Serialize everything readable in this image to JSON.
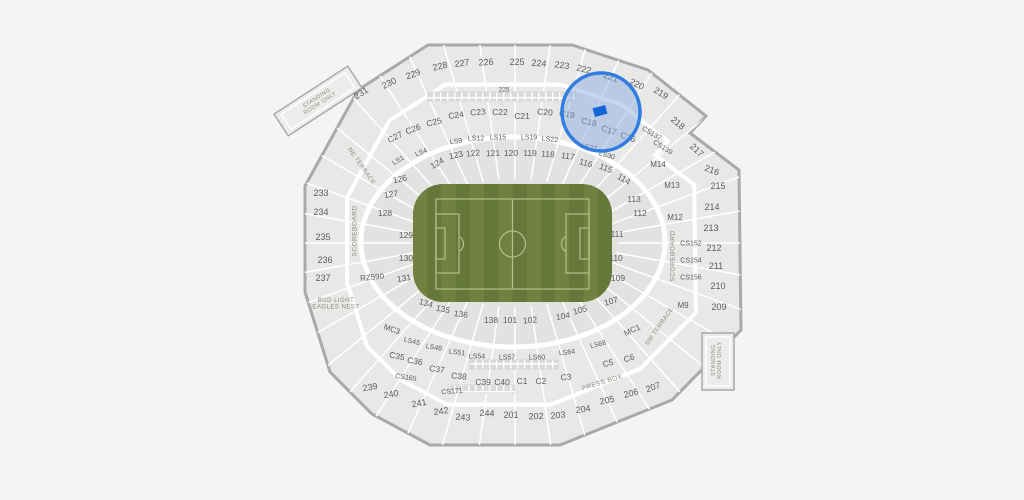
{
  "venue_map": {
    "colors": {
      "background": "#f4f4f2",
      "section_fill": "#e8e8e6",
      "bowl_fill": "#e2e2e0",
      "gap": "#ffffff",
      "outline": "#a9a9a7",
      "suite_square": "#dadad8",
      "label": "#5d5d5b",
      "landmark": "#8a8a82"
    },
    "field": {
      "stripe_light": "#71813f",
      "stripe_dark": "#66773a",
      "line_color": "#b4c08e",
      "x": 413,
      "y": 184,
      "w": 199,
      "h": 118,
      "rx": 30
    },
    "highlight": {
      "cx": 601,
      "cy": 112,
      "r": 39,
      "ring_color": "#2f7de1",
      "ring_width": 3.5,
      "fill": "rgba(128,166,222,0.45)",
      "marker": {
        "x": 600,
        "y": 111,
        "w": 13,
        "h": 9,
        "r": -15,
        "color": "#1465d8"
      }
    },
    "labels": [
      {
        "t": "231",
        "x": 361,
        "y": 93,
        "r": -33,
        "s": 9
      },
      {
        "t": "230",
        "x": 389,
        "y": 83,
        "r": -26,
        "s": 9
      },
      {
        "t": "229",
        "x": 413,
        "y": 74,
        "r": -20,
        "s": 9
      },
      {
        "t": "228",
        "x": 440,
        "y": 66,
        "r": -13,
        "s": 9
      },
      {
        "t": "227",
        "x": 462,
        "y": 63,
        "r": -8,
        "s": 9
      },
      {
        "t": "226",
        "x": 486,
        "y": 62,
        "r": -4,
        "s": 9
      },
      {
        "t": "225",
        "x": 517,
        "y": 62,
        "r": 0,
        "s": 9
      },
      {
        "t": "224",
        "x": 539,
        "y": 63,
        "r": 4,
        "s": 9
      },
      {
        "t": "223",
        "x": 562,
        "y": 65,
        "r": 8,
        "s": 9
      },
      {
        "t": "222",
        "x": 584,
        "y": 69,
        "r": 14,
        "s": 9
      },
      {
        "t": "221",
        "x": 611,
        "y": 77,
        "r": 20,
        "s": 9
      },
      {
        "t": "220",
        "x": 637,
        "y": 84,
        "r": 26,
        "s": 9
      },
      {
        "t": "219",
        "x": 661,
        "y": 93,
        "r": 32,
        "s": 9
      },
      {
        "t": "218",
        "x": 678,
        "y": 123,
        "r": 40,
        "s": 9
      },
      {
        "t": "217",
        "x": 697,
        "y": 150,
        "r": 43,
        "s": 9
      },
      {
        "t": "216",
        "x": 712,
        "y": 170,
        "r": 20,
        "s": 9
      },
      {
        "t": "215",
        "x": 718,
        "y": 186,
        "r": 0,
        "s": 9
      },
      {
        "t": "214",
        "x": 712,
        "y": 207,
        "r": 0,
        "s": 9
      },
      {
        "t": "213",
        "x": 711,
        "y": 228,
        "r": 0,
        "s": 9
      },
      {
        "t": "212",
        "x": 714,
        "y": 248,
        "r": 0,
        "s": 9
      },
      {
        "t": "211",
        "x": 716,
        "y": 266,
        "r": 0,
        "s": 9
      },
      {
        "t": "210",
        "x": 718,
        "y": 286,
        "r": 0,
        "s": 9
      },
      {
        "t": "209",
        "x": 719,
        "y": 307,
        "r": 0,
        "s": 9
      },
      {
        "t": "207",
        "x": 653,
        "y": 387,
        "r": -20,
        "s": 9
      },
      {
        "t": "206",
        "x": 631,
        "y": 393,
        "r": -15,
        "s": 9
      },
      {
        "t": "205",
        "x": 607,
        "y": 400,
        "r": -12,
        "s": 9
      },
      {
        "t": "204",
        "x": 583,
        "y": 409,
        "r": -8,
        "s": 9
      },
      {
        "t": "203",
        "x": 558,
        "y": 415,
        "r": -5,
        "s": 9
      },
      {
        "t": "202",
        "x": 536,
        "y": 416,
        "r": -2,
        "s": 9
      },
      {
        "t": "201",
        "x": 511,
        "y": 415,
        "r": 0,
        "s": 9
      },
      {
        "t": "244",
        "x": 487,
        "y": 413,
        "r": 2,
        "s": 9
      },
      {
        "t": "243",
        "x": 463,
        "y": 417,
        "r": 4,
        "s": 9
      },
      {
        "t": "242",
        "x": 441,
        "y": 411,
        "r": -8,
        "s": 9
      },
      {
        "t": "241",
        "x": 419,
        "y": 403,
        "r": -10,
        "s": 9
      },
      {
        "t": "240",
        "x": 391,
        "y": 394,
        "r": -10,
        "s": 9
      },
      {
        "t": "239",
        "x": 370,
        "y": 387,
        "r": -10,
        "s": 9
      },
      {
        "t": "237",
        "x": 323,
        "y": 278,
        "r": 0,
        "s": 9
      },
      {
        "t": "236",
        "x": 325,
        "y": 260,
        "r": 0,
        "s": 9
      },
      {
        "t": "235",
        "x": 323,
        "y": 237,
        "r": 0,
        "s": 9
      },
      {
        "t": "234",
        "x": 321,
        "y": 212,
        "r": 0,
        "s": 9
      },
      {
        "t": "233",
        "x": 321,
        "y": 193,
        "r": 0,
        "s": 9
      },
      {
        "t": "225",
        "x": 504,
        "y": 89,
        "r": 0,
        "s": 6.5
      },
      {
        "t": "C27",
        "x": 395,
        "y": 137,
        "r": -28
      },
      {
        "t": "C26",
        "x": 413,
        "y": 129,
        "r": -20
      },
      {
        "t": "C25",
        "x": 434,
        "y": 122,
        "r": -14
      },
      {
        "t": "C24",
        "x": 456,
        "y": 115,
        "r": -8
      },
      {
        "t": "C23",
        "x": 478,
        "y": 112,
        "r": -4
      },
      {
        "t": "C22",
        "x": 500,
        "y": 112,
        "r": 0
      },
      {
        "t": "C21",
        "x": 522,
        "y": 116,
        "r": 0
      },
      {
        "t": "C20",
        "x": 545,
        "y": 112,
        "r": 4
      },
      {
        "t": "C19",
        "x": 567,
        "y": 114,
        "r": 10
      },
      {
        "t": "C18",
        "x": 589,
        "y": 122,
        "r": 14
      },
      {
        "t": "C17",
        "x": 609,
        "y": 130,
        "r": 18
      },
      {
        "t": "C16",
        "x": 628,
        "y": 137,
        "r": 22
      },
      {
        "t": "CS137",
        "x": 652,
        "y": 133,
        "r": 30,
        "s": 7
      },
      {
        "t": "CS139",
        "x": 663,
        "y": 147,
        "r": 32,
        "s": 7
      },
      {
        "t": "M14",
        "x": 658,
        "y": 164,
        "r": 0,
        "s": 8
      },
      {
        "t": "M13",
        "x": 672,
        "y": 185,
        "r": 0,
        "s": 8
      },
      {
        "t": "M12",
        "x": 675,
        "y": 217,
        "r": 0,
        "s": 8
      },
      {
        "t": "CS152",
        "x": 691,
        "y": 243,
        "r": 0,
        "s": 7
      },
      {
        "t": "CS154",
        "x": 691,
        "y": 260,
        "r": 0,
        "s": 7
      },
      {
        "t": "CS156",
        "x": 691,
        "y": 277,
        "r": 0,
        "s": 7
      },
      {
        "t": "M9",
        "x": 683,
        "y": 305,
        "r": 0,
        "s": 8
      },
      {
        "t": "MC1",
        "x": 632,
        "y": 330,
        "r": -25,
        "s": 8
      },
      {
        "t": "C6",
        "x": 629,
        "y": 358,
        "r": -18
      },
      {
        "t": "C5",
        "x": 608,
        "y": 363,
        "r": -14
      },
      {
        "t": "C3",
        "x": 566,
        "y": 377,
        "r": -6
      },
      {
        "t": "C2",
        "x": 541,
        "y": 381,
        "r": -2
      },
      {
        "t": "C1",
        "x": 522,
        "y": 381,
        "r": 0
      },
      {
        "t": "C40",
        "x": 502,
        "y": 382,
        "r": 0
      },
      {
        "t": "C39",
        "x": 483,
        "y": 382,
        "r": 0
      },
      {
        "t": "CS171",
        "x": 452,
        "y": 391,
        "r": -5,
        "s": 7
      },
      {
        "t": "C38",
        "x": 459,
        "y": 376,
        "r": 5
      },
      {
        "t": "C37",
        "x": 437,
        "y": 369,
        "r": 8
      },
      {
        "t": "C36",
        "x": 415,
        "y": 361,
        "r": 10
      },
      {
        "t": "CS165",
        "x": 406,
        "y": 377,
        "r": 8,
        "s": 7
      },
      {
        "t": "C35",
        "x": 397,
        "y": 356,
        "r": 12
      },
      {
        "t": "MC3",
        "x": 392,
        "y": 329,
        "r": 20,
        "s": 8
      },
      {
        "t": "RZ590",
        "x": 372,
        "y": 277,
        "r": -6,
        "s": 8
      },
      {
        "t": "LS1",
        "x": 398,
        "y": 160,
        "r": -32,
        "s": 7
      },
      {
        "t": "LS4",
        "x": 421,
        "y": 152,
        "r": -22,
        "s": 7
      },
      {
        "t": "LS9",
        "x": 456,
        "y": 141,
        "r": -8,
        "s": 7
      },
      {
        "t": "LS12",
        "x": 476,
        "y": 138,
        "r": 0,
        "s": 7
      },
      {
        "t": "LS15",
        "x": 498,
        "y": 137,
        "r": 0,
        "s": 7
      },
      {
        "t": "LS19",
        "x": 529,
        "y": 137,
        "r": 0,
        "s": 7
      },
      {
        "t": "LS22",
        "x": 550,
        "y": 139,
        "r": 4,
        "s": 7
      },
      {
        "t": "LS27",
        "x": 589,
        "y": 147,
        "r": 12,
        "s": 7
      },
      {
        "t": "LS30",
        "x": 607,
        "y": 155,
        "r": 16,
        "s": 7
      },
      {
        "t": "LS45",
        "x": 412,
        "y": 341,
        "r": 14,
        "s": 7
      },
      {
        "t": "LS48",
        "x": 434,
        "y": 347,
        "r": 10,
        "s": 7
      },
      {
        "t": "LS51",
        "x": 457,
        "y": 352,
        "r": 7,
        "s": 7
      },
      {
        "t": "LS54",
        "x": 477,
        "y": 356,
        "r": 0,
        "s": 7
      },
      {
        "t": "LS57",
        "x": 507,
        "y": 357,
        "r": 0,
        "s": 7
      },
      {
        "t": "LS60",
        "x": 537,
        "y": 357,
        "r": 0,
        "s": 7
      },
      {
        "t": "LS64",
        "x": 567,
        "y": 352,
        "r": -7,
        "s": 7
      },
      {
        "t": "LS68",
        "x": 598,
        "y": 344,
        "r": -12,
        "s": 7
      },
      {
        "t": "124",
        "x": 437,
        "y": 163,
        "r": -30
      },
      {
        "t": "123",
        "x": 456,
        "y": 155,
        "r": -12
      },
      {
        "t": "122",
        "x": 473,
        "y": 153,
        "r": -6
      },
      {
        "t": "121",
        "x": 493,
        "y": 153,
        "r": -2
      },
      {
        "t": "120",
        "x": 511,
        "y": 153,
        "r": 0
      },
      {
        "t": "119",
        "x": 530,
        "y": 153,
        "r": 0
      },
      {
        "t": "118",
        "x": 548,
        "y": 154,
        "r": 4
      },
      {
        "t": "117",
        "x": 568,
        "y": 156,
        "r": 8
      },
      {
        "t": "116",
        "x": 586,
        "y": 163,
        "r": 16
      },
      {
        "t": "115",
        "x": 606,
        "y": 168,
        "r": 22
      },
      {
        "t": "114",
        "x": 624,
        "y": 179,
        "r": 30
      },
      {
        "t": "113",
        "x": 634,
        "y": 199,
        "r": 0
      },
      {
        "t": "112",
        "x": 640,
        "y": 213,
        "r": 0
      },
      {
        "t": "111",
        "x": 617,
        "y": 234,
        "r": 0
      },
      {
        "t": "110",
        "x": 616,
        "y": 258,
        "r": 0
      },
      {
        "t": "109",
        "x": 618,
        "y": 278,
        "r": 0
      },
      {
        "t": "107",
        "x": 611,
        "y": 301,
        "r": -15
      },
      {
        "t": "105",
        "x": 580,
        "y": 310,
        "r": -16
      },
      {
        "t": "104",
        "x": 563,
        "y": 316,
        "r": -10
      },
      {
        "t": "102",
        "x": 530,
        "y": 320,
        "r": -4
      },
      {
        "t": "101",
        "x": 510,
        "y": 320,
        "r": 0
      },
      {
        "t": "138",
        "x": 491,
        "y": 320,
        "r": 0
      },
      {
        "t": "136",
        "x": 461,
        "y": 314,
        "r": 8
      },
      {
        "t": "135",
        "x": 443,
        "y": 309,
        "r": 12
      },
      {
        "t": "134",
        "x": 426,
        "y": 303,
        "r": 16
      },
      {
        "t": "131",
        "x": 404,
        "y": 278,
        "r": -8
      },
      {
        "t": "130",
        "x": 406,
        "y": 258,
        "r": 0
      },
      {
        "t": "129",
        "x": 406,
        "y": 235,
        "r": 0
      },
      {
        "t": "128",
        "x": 385,
        "y": 213,
        "r": 0
      },
      {
        "t": "127",
        "x": 391,
        "y": 194,
        "r": -8
      },
      {
        "t": "126",
        "x": 400,
        "y": 179,
        "r": -12
      },
      {
        "t": "SCOREBOARD",
        "x": 354,
        "y": 231,
        "r": -90,
        "s": 6.5,
        "k": "landmark"
      },
      {
        "t": "SCOREBOARD",
        "x": 672,
        "y": 256,
        "r": -90,
        "s": 6.5,
        "k": "landmark"
      },
      {
        "lines": [
          "STANDING",
          "ROOM ONLY"
        ],
        "x": 318,
        "y": 100,
        "r": -33,
        "s": 5.5,
        "k": "landmark"
      },
      {
        "lines": [
          "STANDING",
          "ROOM ONLY"
        ],
        "x": 716,
        "y": 360,
        "r": -90,
        "s": 5.5,
        "k": "landmark"
      },
      {
        "lines": [
          "BUD LIGHT",
          "EAGLES NEST"
        ],
        "x": 336,
        "y": 303,
        "r": 0,
        "s": 6,
        "k": "landmark"
      },
      {
        "t": "PRESS BOX",
        "x": 602,
        "y": 382,
        "r": -17,
        "s": 6.5,
        "k": "landmark"
      },
      {
        "t": "SW TERRACE",
        "x": 659,
        "y": 326,
        "r": -55,
        "s": 6,
        "k": "landmark"
      },
      {
        "t": "NE TERRACE",
        "x": 362,
        "y": 166,
        "r": 55,
        "s": 6,
        "k": "landmark"
      }
    ]
  }
}
